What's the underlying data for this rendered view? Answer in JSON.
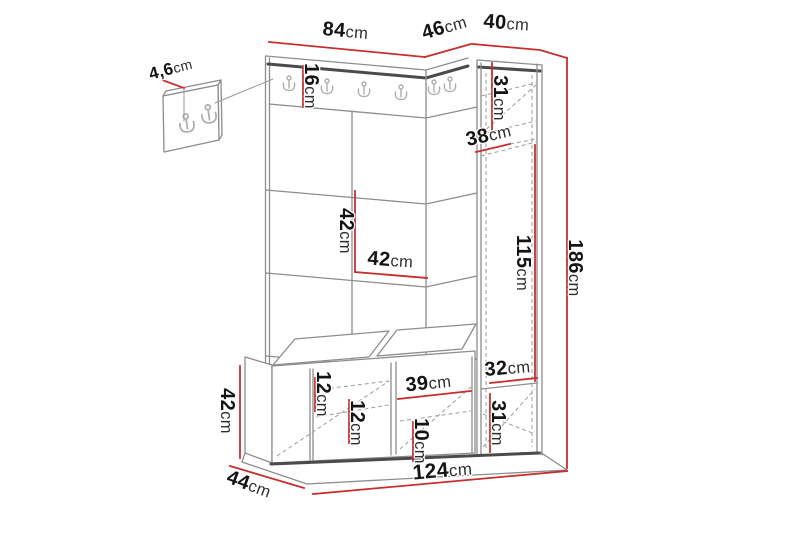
{
  "diagram": {
    "kind": "furniture dimension drawing",
    "subject": "hallway wardrobe set with coat rack panel, shoe bench and tall cabinet",
    "unit": "cm",
    "colors": {
      "dimension_lines": "#c62f2f",
      "structure": "#8d8d8d",
      "structure_dark": "#4b4b4b",
      "text": "#141414"
    }
  },
  "dimensions": {
    "detail_thickness": {
      "value": "4,6",
      "unit": "cm"
    },
    "main_panel_width": {
      "value": "84",
      "unit": "cm"
    },
    "corner_width": {
      "value": "46",
      "unit": "cm"
    },
    "cabinet_width": {
      "value": "40",
      "unit": "cm"
    },
    "rail_height": {
      "value": "16",
      "unit": "cm"
    },
    "cabinet_top_section": {
      "value": "31",
      "unit": "cm"
    },
    "shelf_depth": {
      "value": "38",
      "unit": "cm"
    },
    "tile_height": {
      "value": "42",
      "unit": "cm"
    },
    "tile_width": {
      "value": "42",
      "unit": "cm"
    },
    "cabinet_middle_height": {
      "value": "115",
      "unit": "cm"
    },
    "total_height": {
      "value": "186",
      "unit": "cm"
    },
    "bench_top_inset": {
      "value": "12",
      "unit": "cm"
    },
    "bench_shelf_gap": {
      "value": "12",
      "unit": "cm"
    },
    "bench_door_width": {
      "value": "39",
      "unit": "cm"
    },
    "bench_bottom_gap": {
      "value": "10",
      "unit": "cm"
    },
    "cabinet_lower_upper": {
      "value": "32",
      "unit": "cm"
    },
    "cabinet_lower_drawer": {
      "value": "31",
      "unit": "cm"
    },
    "bench_height": {
      "value": "42",
      "unit": "cm"
    },
    "bench_depth": {
      "value": "44",
      "unit": "cm"
    },
    "total_width": {
      "value": "124",
      "unit": "cm"
    }
  }
}
